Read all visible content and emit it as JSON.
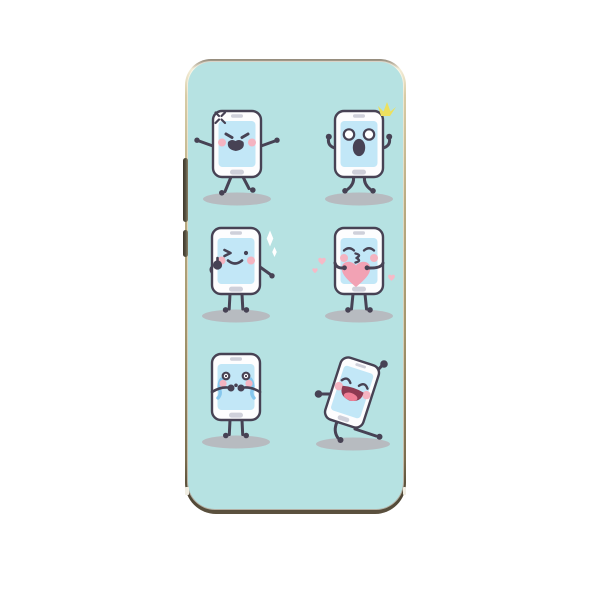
{
  "product": {
    "name": "cartoon-smartphone-phone-case",
    "description": "Phone case back with six cartoon smartphone characters on a teal background inside a gold metallic frame"
  },
  "palette": {
    "page_bg": "#ffffff",
    "case_teal": "#b6e2e2",
    "frame_top": "#918879",
    "frame_hi": "#f3ecd6",
    "frame_mid": "#b9ab82",
    "frame_dark": "#7a6c4e",
    "frame_deep": "#4e4534",
    "button_metal": "#55503f",
    "notch": "#f0ede2",
    "outline": "#474254",
    "body_white": "#fdfdfe",
    "screen_blue": "#c2e7f7",
    "hardware_gray": "#cfd0da",
    "cheek_pink": "#f4b4c1",
    "heart_pink": "#f2a2b4",
    "heart_pink_light": "#f5bac7",
    "mouth_maroon": "#8e3a52",
    "tongue_red": "#ef7f96",
    "tear_blue": "#86c7ee",
    "sparkle_yellow": "#ece05e",
    "sparkle_white": "#ffffff",
    "shadow_gray": "#b7bbc0"
  },
  "case": {
    "side_button_count": 2,
    "grid": "2 columns x 3 rows of characters"
  },
  "characters": [
    {
      "id": "angry",
      "label": "angry phone character with anger-vein mark",
      "decorations": [
        "anger-vein-icon"
      ]
    },
    {
      "id": "surprised",
      "label": "surprised phone character with yellow flash spark",
      "decorations": [
        "flash-sparkle-icon"
      ]
    },
    {
      "id": "wink",
      "label": "winking thumbs-up phone character with sparkles",
      "decorations": [
        "diamond-sparkle-icon"
      ]
    },
    {
      "id": "kiss",
      "label": "kissing phone character holding a pink heart",
      "decorations": [
        "kiss-heart-icon",
        "mini-heart-icon"
      ]
    },
    {
      "id": "crying",
      "label": "crying phone character with blue tears",
      "decorations": [
        "tear-streams"
      ]
    },
    {
      "id": "dancing",
      "label": "dancing laughing phone character",
      "decorations": []
    }
  ]
}
